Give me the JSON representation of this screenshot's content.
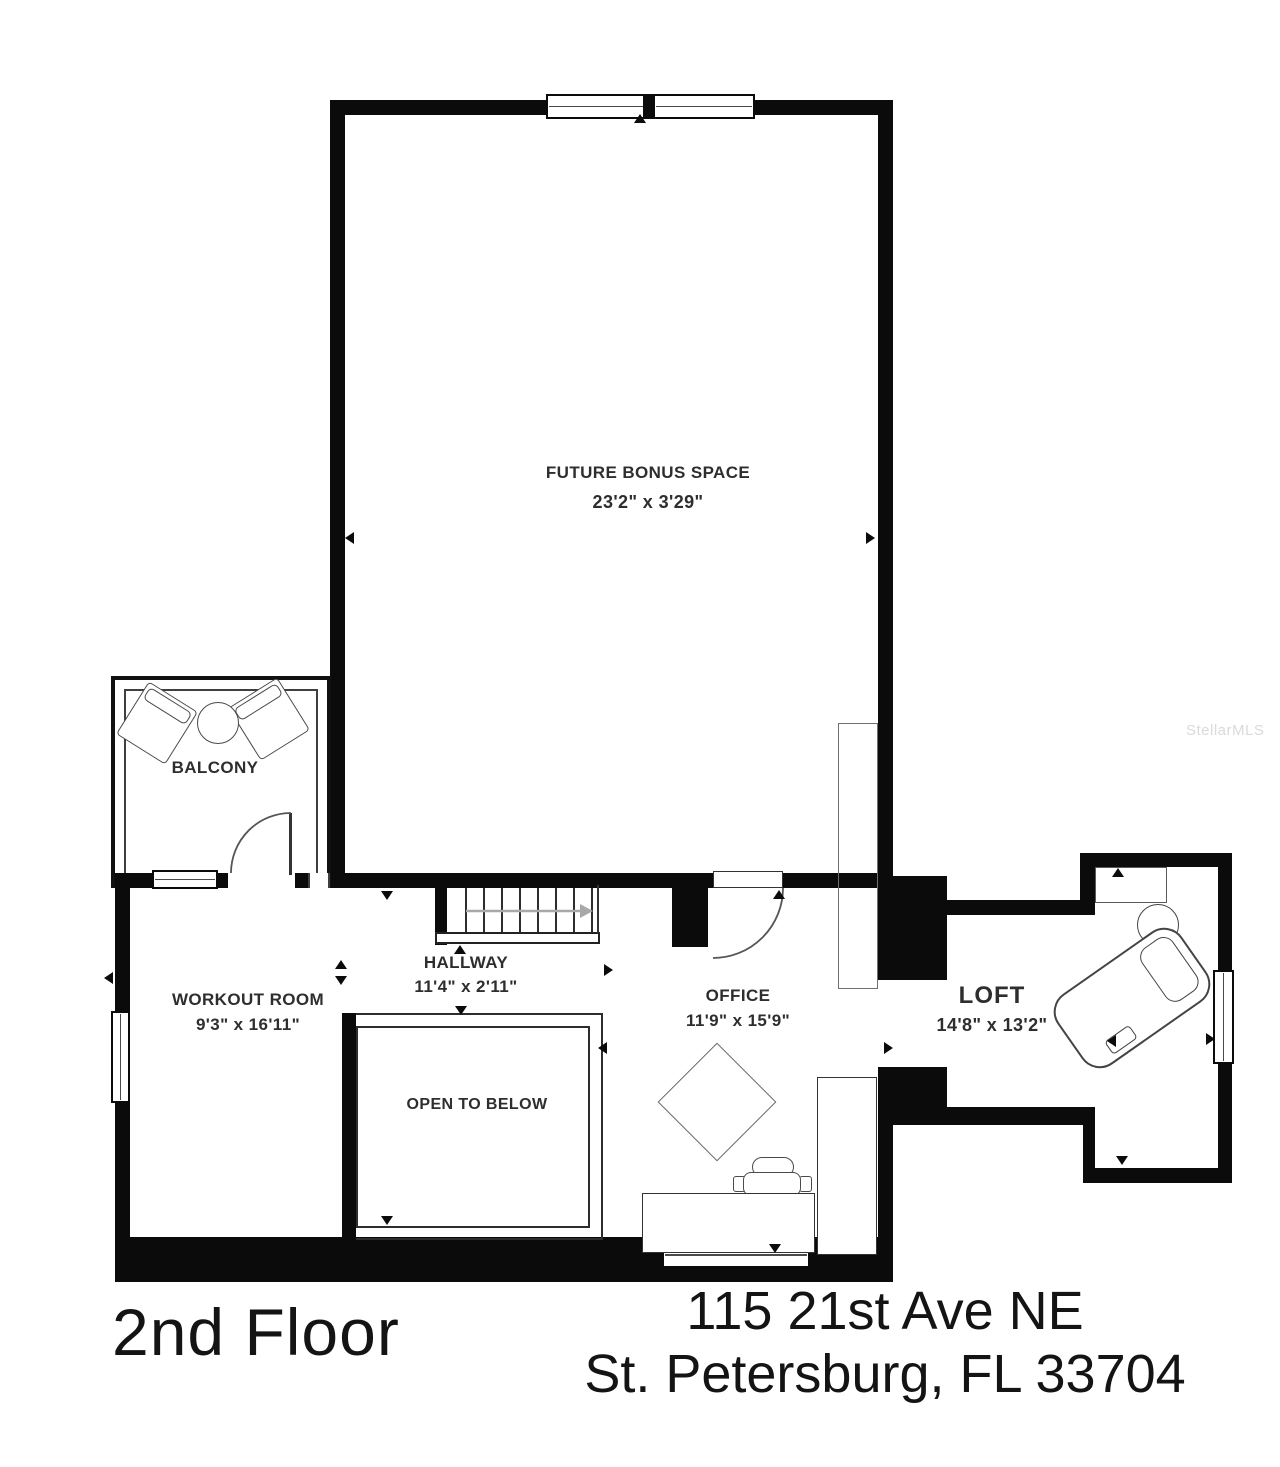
{
  "title": "2nd floor residential floor plan",
  "floor_label": "2nd Floor",
  "address": {
    "line1": "115 21st Ave NE",
    "line2": "St. Petersburg, FL 33704"
  },
  "watermark": "StellarMLS",
  "rooms": {
    "bonus": {
      "name": "FUTURE BONUS SPACE",
      "dims": "23'2\" x 3'29\""
    },
    "balcony": {
      "name": "BALCONY"
    },
    "hallway": {
      "name": "HALLWAY",
      "dims": "11'4\" x 2'11\""
    },
    "workout": {
      "name": "WORKOUT ROOM",
      "dims": "9'3\" x 16'11\""
    },
    "open_below": {
      "name": "OPEN TO BELOW"
    },
    "office": {
      "name": "OFFICE",
      "dims": "11'9\" x 15'9\""
    },
    "loft": {
      "name": "LOFT",
      "dims": "14'8\" x 13'2\""
    }
  },
  "colors": {
    "wall": "#0b0b0b",
    "thin_line": "#4a4a4a",
    "watermark": "#dadada",
    "label": "#2e2e2e"
  }
}
